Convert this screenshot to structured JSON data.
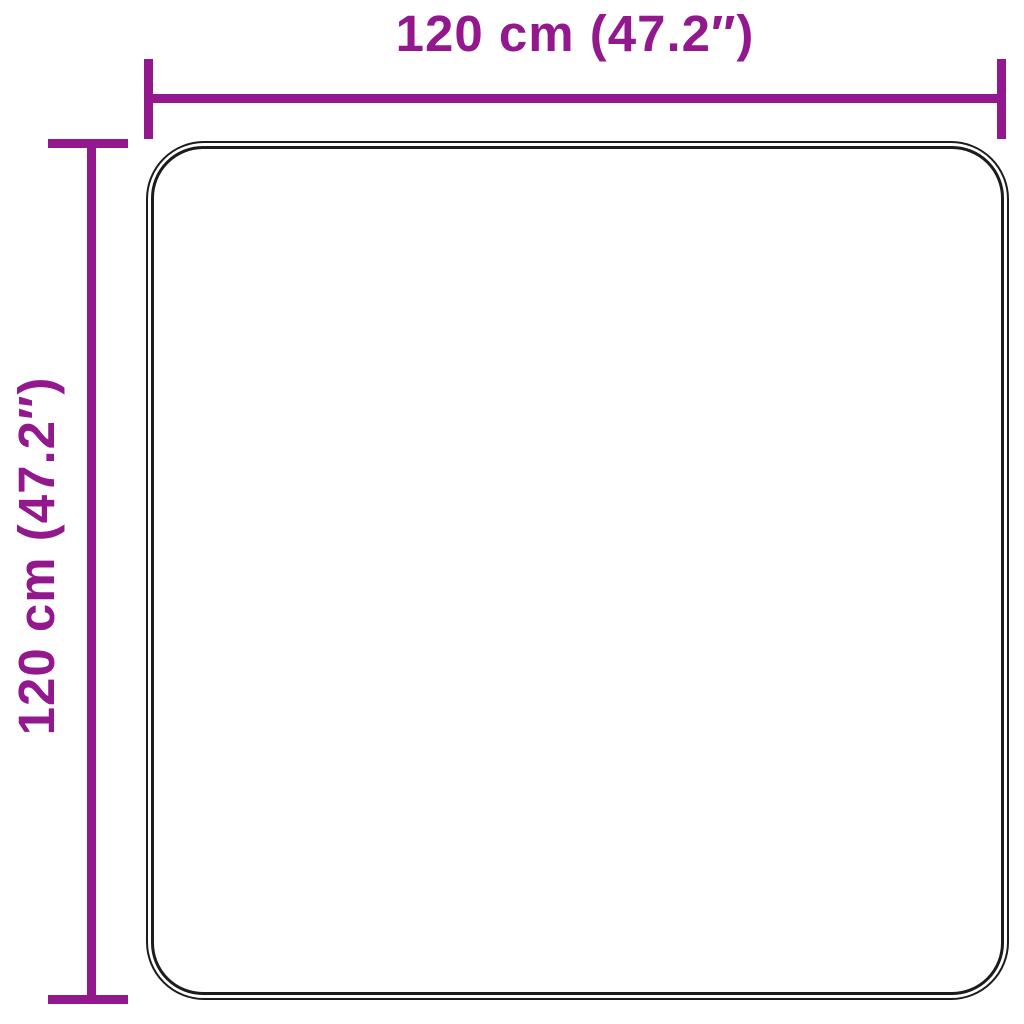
{
  "diagram": {
    "type": "product-dimension-diagram",
    "product_shape": "rounded-square-rug-top-view",
    "width_label": "120 cm (47.2″)",
    "height_label": "120 cm (47.2″)",
    "colors": {
      "accent": "#93188E",
      "outline": "#1c1c1c",
      "background": "#ffffff"
    }
  }
}
